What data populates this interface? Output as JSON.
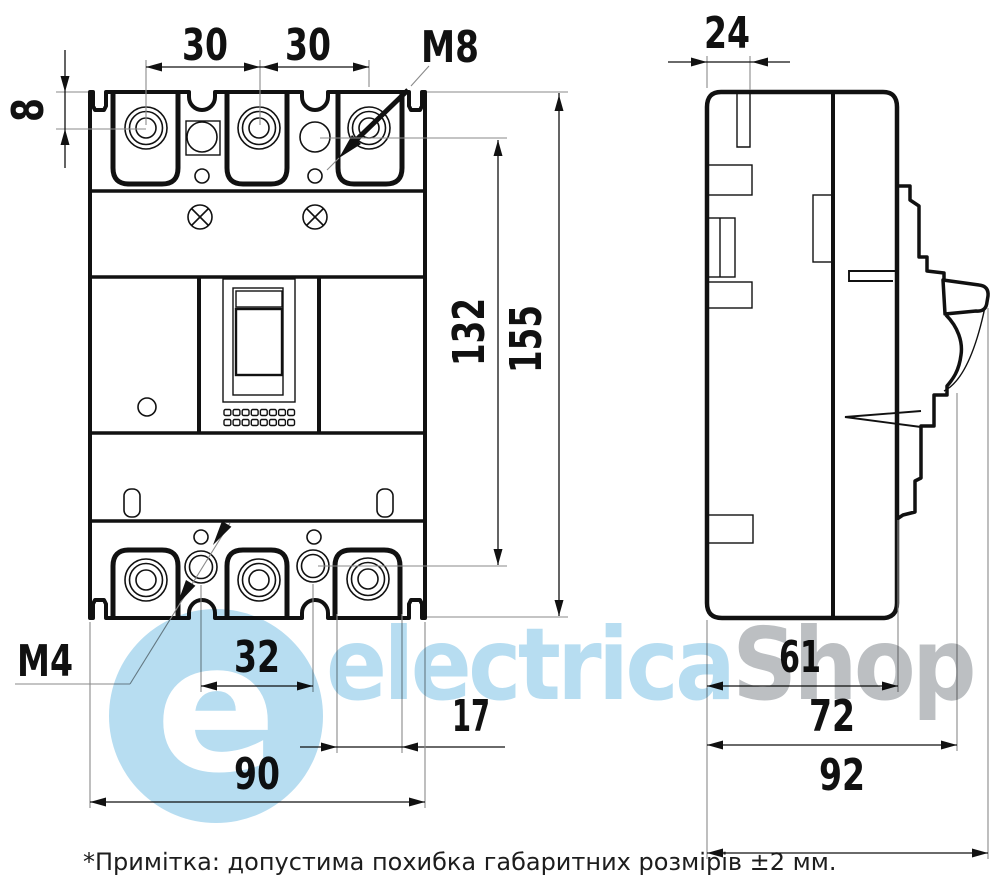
{
  "front_view": {
    "dim_edge_offset": "8",
    "dim_pole_pitch_left": "30",
    "dim_pole_pitch_right": "30",
    "terminal_thread_label": "M8",
    "dim_hole_span": "132",
    "dim_height": "155",
    "aux_thread_label": "M4",
    "dim_aux_hole_pitch": "32",
    "dim_terminal_width": "17",
    "dim_width": "90"
  },
  "side_view": {
    "dim_top_depth": "24",
    "dim_body_depth": "61",
    "dim_mid_depth": "72",
    "dim_overall_depth": "92"
  },
  "note": "*Примітка: допустима похибка габаритних розмірів ±2 мм.",
  "watermark": {
    "logo_letter": "e",
    "brand_primary": "electrica",
    "brand_secondary": "Shop"
  },
  "colors": {
    "line": "#111111",
    "thin-line": "#8a8a8a",
    "wm-blue": "#b7ddf1",
    "wm-gray": "#bcbfc2",
    "bg": "#ffffff"
  }
}
